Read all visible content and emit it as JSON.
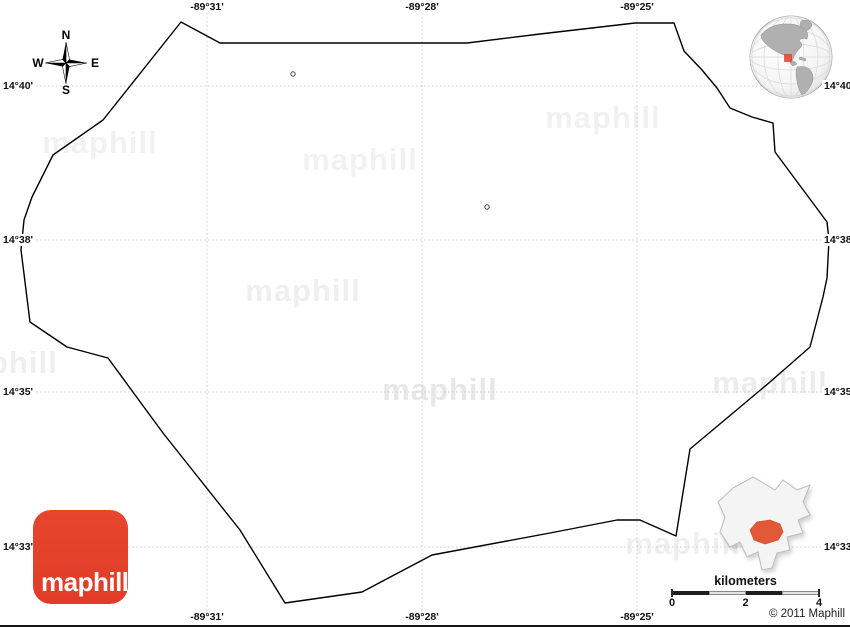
{
  "map": {
    "boundary": {
      "color": "#000000",
      "points": [
        [
          181,
          22
        ],
        [
          220,
          43
        ],
        [
          467,
          43
        ],
        [
          540,
          34
        ],
        [
          635,
          23
        ],
        [
          674,
          23
        ],
        [
          684,
          51
        ],
        [
          702,
          70
        ],
        [
          717,
          88
        ],
        [
          730,
          108
        ],
        [
          752,
          117
        ],
        [
          773,
          123
        ],
        [
          775,
          152
        ],
        [
          827,
          222
        ],
        [
          829,
          240
        ],
        [
          827,
          278
        ],
        [
          823,
          297
        ],
        [
          810,
          347
        ],
        [
          770,
          382
        ],
        [
          690,
          449
        ],
        [
          676,
          536
        ],
        [
          640,
          520
        ],
        [
          617,
          520
        ],
        [
          550,
          533
        ],
        [
          432,
          555
        ],
        [
          362,
          592
        ],
        [
          285,
          603
        ],
        [
          240,
          530
        ],
        [
          163,
          433
        ],
        [
          108,
          358
        ],
        [
          67,
          347
        ],
        [
          30,
          322
        ],
        [
          21,
          250
        ],
        [
          24,
          220
        ],
        [
          32,
          197
        ],
        [
          53,
          155
        ],
        [
          103,
          120
        ]
      ]
    },
    "markers": [
      {
        "x": 293,
        "y": 74
      },
      {
        "x": 487,
        "y": 207
      }
    ],
    "grid": {
      "color": "#cccccc",
      "vertical_x": [
        207,
        422,
        637
      ],
      "horizontal_y": [
        86,
        240,
        392,
        547
      ]
    },
    "labels": {
      "top": [
        {
          "text": "-89°31'",
          "x": 207
        },
        {
          "text": "-89°28'",
          "x": 422
        },
        {
          "text": "-89°25'",
          "x": 637
        }
      ],
      "bottom": [
        {
          "text": "-89°31'",
          "x": 207
        },
        {
          "text": "-89°28'",
          "x": 422
        },
        {
          "text": "-89°25'",
          "x": 637
        }
      ],
      "left": [
        {
          "text": "14°40'",
          "y": 86
        },
        {
          "text": "14°38'",
          "y": 240
        },
        {
          "text": "14°35'",
          "y": 392
        },
        {
          "text": "14°33'",
          "y": 547
        }
      ],
      "right": [
        {
          "text": "14°40'",
          "y": 86
        },
        {
          "text": "14°38'",
          "y": 240
        },
        {
          "text": "14°35'",
          "y": 392
        },
        {
          "text": "14°33'",
          "y": 547
        }
      ]
    }
  },
  "compass": {
    "north": "N",
    "south": "S",
    "east": "E",
    "west": "W"
  },
  "watermark": {
    "text": "maphill",
    "positions": [
      {
        "x": 100,
        "y": 143,
        "o": 0.05
      },
      {
        "x": 360,
        "y": 160,
        "o": 0.05
      },
      {
        "x": 603,
        "y": 118,
        "o": 0.05
      },
      {
        "x": 303,
        "y": 291,
        "o": 0.06
      },
      {
        "x": 0,
        "y": 363,
        "o": 0.06
      },
      {
        "x": 440,
        "y": 390,
        "o": 0.09
      },
      {
        "x": 770,
        "y": 383,
        "o": 0.07
      },
      {
        "x": 683,
        "y": 544,
        "o": 0.06
      }
    ]
  },
  "logo": {
    "text": "maphill",
    "bg": "#e03c28",
    "fg": "#ffffff"
  },
  "scale_bar": {
    "title": "kilometers",
    "tick_labels": [
      "0",
      "2",
      "4"
    ],
    "segments": [
      "dark",
      "light",
      "dark",
      "light"
    ],
    "dark_color": "#1c1c1c",
    "light_color": "#e3e3e3"
  },
  "copyright": "© 2011 Maphill",
  "globe": {
    "land": "#b0b0b0",
    "grid": "#d8d8d8",
    "marker": "#f05540",
    "outline": "#999999"
  },
  "inset": {
    "fill": "#f4f4f4",
    "stroke": "#bcbcbc",
    "highlight": "#e2593a"
  }
}
